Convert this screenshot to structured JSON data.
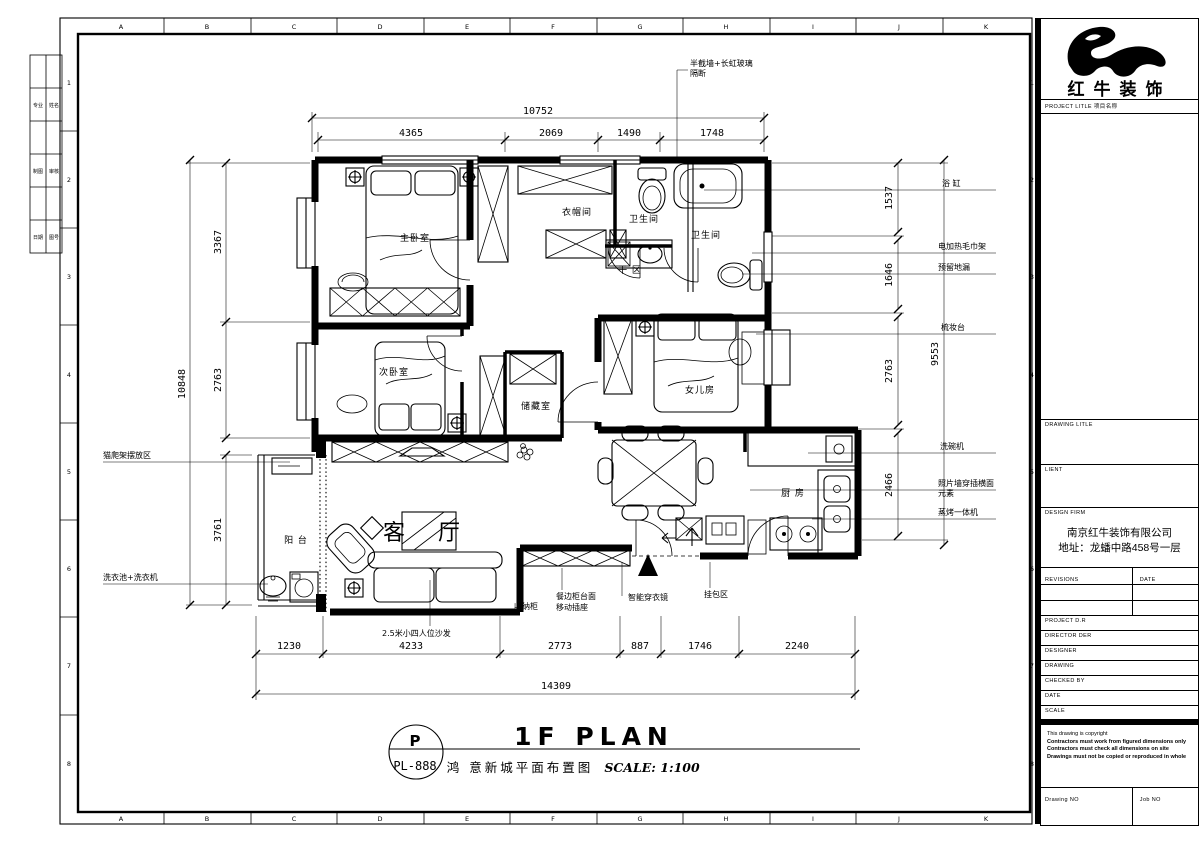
{
  "sheet": {
    "grid_letters": [
      "A",
      "B",
      "C",
      "D",
      "E",
      "F",
      "G",
      "H",
      "I",
      "J",
      "K"
    ],
    "grid_numbers": [
      "1",
      "2",
      "3",
      "4",
      "5",
      "6",
      "7",
      "8"
    ],
    "signoff": {
      "c1": [
        "专业",
        "制图",
        "日期"
      ],
      "c2": [
        "姓名",
        "审核",
        "图号"
      ]
    }
  },
  "plan": {
    "rooms": {
      "master": "主卧室",
      "cloak": "衣帽间",
      "bath1": "卫生间",
      "bath2": "卫生间",
      "dry": "干 区",
      "second": "次卧室",
      "storage": "储藏室",
      "daughter": "女儿房",
      "kitchen": "厨 房",
      "living": "客 厅",
      "balcony": "阳 台"
    },
    "callouts": {
      "partition1": "半截墙+长虹玻璃",
      "partition2": "隔断",
      "bathtub": "浴 缸",
      "towel_rack": "电加热毛巾架",
      "floor_drain": "预留地漏",
      "dresser": "梳妆台",
      "dishwasher": "洗碗机",
      "photo_wall1": "照片墙穿插横面",
      "photo_wall2": "元素",
      "steam_oven": "蒸烤一体机",
      "cat_tree": "猫爬架摆放区",
      "laundry": "洗衣池+洗衣机",
      "sofa": "2.5米小四人位沙发",
      "storage_cabinet": "收纳柜",
      "sideboard1": "餐边柜台面",
      "sideboard2": "移动插座",
      "mirror": "智能穿衣镜",
      "bag_area": "挂包区"
    }
  },
  "dimensions": {
    "top_total": "10752",
    "top": [
      "4365",
      "2069",
      "1490",
      "1748"
    ],
    "left_total": "10848",
    "left": [
      "3367",
      "2763",
      "3761"
    ],
    "right_total": "9553",
    "right": [
      "1537",
      "1646",
      "2763",
      "2466"
    ],
    "bottom_total": "14309",
    "bottom": [
      "1230",
      "4233",
      "2773",
      "887",
      "1746",
      "2240"
    ]
  },
  "footer": {
    "stamp_letter": "P",
    "stamp_no": "PL-888",
    "title_en": "1F PLAN",
    "title_cn": "鸿 意新城平面布置图",
    "scale": "SCALE: 1:100"
  },
  "titleblock": {
    "brand": "红牛装饰",
    "project_label": "PROJECT LITLE 项目名称",
    "drawing_label": "DRAWING LITLE",
    "client_label": "LIENT",
    "firm_label": "DESIGN FIRM",
    "firm_name": "南京红牛装饰有限公司",
    "firm_address": "地址：龙蟠中路458号一层",
    "revisions_label": "REVISIONS",
    "rev_date_label": "DATE",
    "rows": [
      "PROJECT D.R",
      "DIRECTOR DER",
      "DESIGNER",
      "DRAWING",
      "CHECKED BY",
      "DATE",
      "SCALE"
    ],
    "copyright": "This drawing is copyright",
    "copy1": "Contractors must work from figured dimensions only",
    "copy2": "Contractors must check all dimensions on site",
    "copy3": "Drawings must not be copied or reproduced in whole",
    "drawing_no_label": "Drawing NO",
    "job_no_label": "Job NO"
  }
}
